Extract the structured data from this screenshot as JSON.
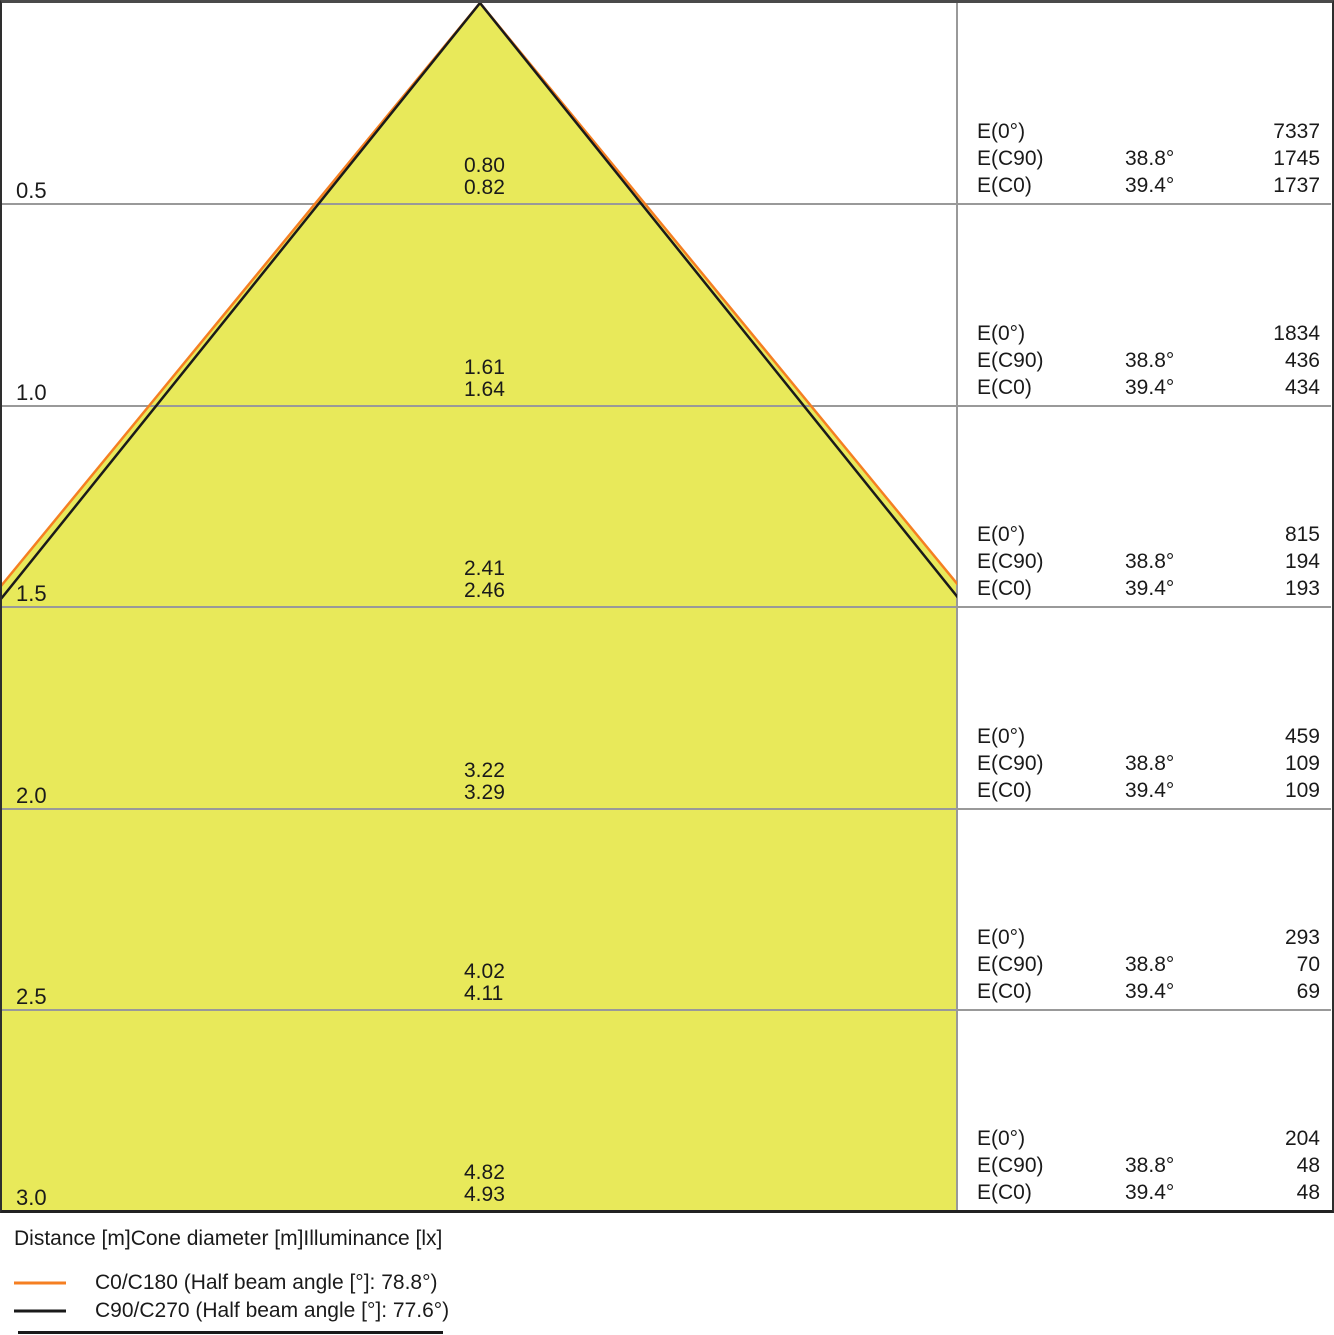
{
  "colors": {
    "cone_fill": "#e8e95a",
    "c0_line": "#f57f22",
    "c90_line": "#1a1a1a",
    "grid_line": "#999999",
    "border": "#2e2e2e"
  },
  "rows": [
    {
      "distance": "0.5",
      "diameter_c90": "0.80",
      "diameter_c0": "0.82",
      "e0_label": "E(0°)",
      "e0_value": "7337",
      "ec90_label": "E(C90)",
      "ec90_angle": "38.8°",
      "ec90_value": "1745",
      "ec0_label": "E(C0)",
      "ec0_angle": "39.4°",
      "ec0_value": "1737"
    },
    {
      "distance": "1.0",
      "diameter_c90": "1.61",
      "diameter_c0": "1.64",
      "e0_label": "E(0°)",
      "e0_value": "1834",
      "ec90_label": "E(C90)",
      "ec90_angle": "38.8°",
      "ec90_value": "436",
      "ec0_label": "E(C0)",
      "ec0_angle": "39.4°",
      "ec0_value": "434"
    },
    {
      "distance": "1.5",
      "diameter_c90": "2.41",
      "diameter_c0": "2.46",
      "e0_label": "E(0°)",
      "e0_value": "815",
      "ec90_label": "E(C90)",
      "ec90_angle": "38.8°",
      "ec90_value": "194",
      "ec0_label": "E(C0)",
      "ec0_angle": "39.4°",
      "ec0_value": "193"
    },
    {
      "distance": "2.0",
      "diameter_c90": "3.22",
      "diameter_c0": "3.29",
      "e0_label": "E(0°)",
      "e0_value": "459",
      "ec90_label": "E(C90)",
      "ec90_angle": "38.8°",
      "ec90_value": "109",
      "ec0_label": "E(C0)",
      "ec0_angle": "39.4°",
      "ec0_value": "109"
    },
    {
      "distance": "2.5",
      "diameter_c90": "4.02",
      "diameter_c0": "4.11",
      "e0_label": "E(0°)",
      "e0_value": "293",
      "ec90_label": "E(C90)",
      "ec90_angle": "38.8°",
      "ec90_value": "70",
      "ec0_label": "E(C0)",
      "ec0_angle": "39.4°",
      "ec0_value": "69"
    },
    {
      "distance": "3.0",
      "diameter_c90": "4.82",
      "diameter_c0": "4.93",
      "e0_label": "E(0°)",
      "e0_value": "204",
      "ec90_label": "E(C90)",
      "ec90_angle": "38.8°",
      "ec90_value": "48",
      "ec0_label": "E(C0)",
      "ec0_angle": "39.4°",
      "ec0_value": "48"
    }
  ],
  "footer": {
    "caption": "Distance [m]Cone diameter [m]Illuminance [lx]",
    "legend": [
      {
        "label": "C0/C180 (Half beam angle [°]: 78.8°)",
        "color": "#f57f22"
      },
      {
        "label": "C90/C270 (Half beam angle [°]: 77.6°)",
        "color": "#1a1a1a"
      }
    ]
  },
  "chart_data": {
    "type": "area",
    "title": "Light cone diagram",
    "xlabel": "Cone diameter [m]",
    "ylabel": "Distance [m]",
    "distances_m": [
      0.5,
      1.0,
      1.5,
      2.0,
      2.5,
      3.0
    ],
    "E0_lx": [
      7337,
      1834,
      815,
      459,
      293,
      204
    ],
    "series": [
      {
        "name": "C0/C180 (Half beam angle [°]: 78.8°)",
        "plane": "C0/C180",
        "half_angle_deg": 39.4,
        "color": "#f57f22",
        "cone_diameter_m": [
          0.82,
          1.64,
          2.46,
          3.29,
          4.11,
          4.93
        ],
        "E_C0_lx": [
          1737,
          434,
          193,
          109,
          69,
          48
        ]
      },
      {
        "name": "C90/C270 (Half beam angle [°]: 77.6°)",
        "plane": "C90/C270",
        "half_angle_deg": 38.8,
        "color": "#1a1a1a",
        "cone_diameter_m": [
          0.8,
          1.61,
          2.41,
          3.22,
          4.02,
          4.82
        ],
        "E_C90_lx": [
          1745,
          436,
          194,
          109,
          70,
          48
        ]
      }
    ],
    "grid": true,
    "legend_position": "bottom-left",
    "ylim": [
      0,
      3.0
    ]
  }
}
